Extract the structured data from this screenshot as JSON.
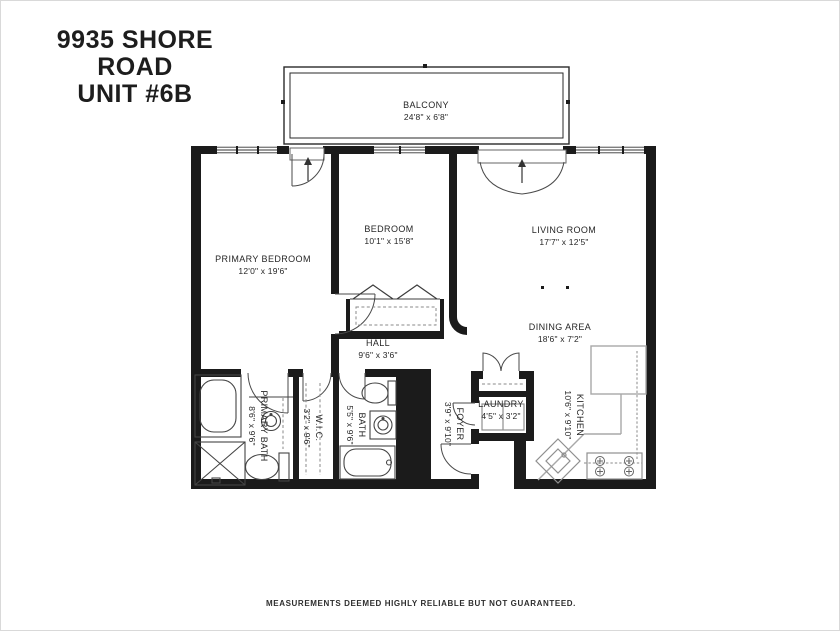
{
  "title": {
    "line1": "9935 SHORE ROAD",
    "line2": "UNIT #6B"
  },
  "footer": "MEASUREMENTS DEEMED HIGHLY RELIABLE BUT NOT GUARANTEED.",
  "colors": {
    "wall": "#1b1b1b",
    "fixture_line": "#444444",
    "counter": "#a8a8a8",
    "text": "#262626"
  },
  "rooms": {
    "balcony": {
      "name": "BALCONY",
      "dims": "24'8\" x 6'8\""
    },
    "primary_bedroom": {
      "name": "PRIMARY BEDROOM",
      "dims": "12'0\" x 19'6\""
    },
    "bedroom": {
      "name": "BEDROOM",
      "dims": "10'1\" x 15'8\""
    },
    "living_room": {
      "name": "LIVING ROOM",
      "dims": "17'7\" x 12'5\""
    },
    "dining_area": {
      "name": "DINING AREA",
      "dims": "18'6\" x 7'2\""
    },
    "hall": {
      "name": "HALL",
      "dims": "9'6\" x 3'6\""
    },
    "kitchen": {
      "name": "KITCHEN",
      "dims": "10'6\" x 9'10\""
    },
    "foyer": {
      "name": "FOYER",
      "dims": "3'9\" x 9'10\""
    },
    "laundry": {
      "name": "LAUNDRY",
      "dims": "4'5\" x 3'2\""
    },
    "primary_bath": {
      "name": "PRIMARY BATH",
      "dims": "8'6\" x 9'6\""
    },
    "wic": {
      "name": "W.I.C.",
      "dims": "3'2\" x 9'6\""
    },
    "bath": {
      "name": "BATH",
      "dims": "5'5\" x 9'6\""
    }
  }
}
